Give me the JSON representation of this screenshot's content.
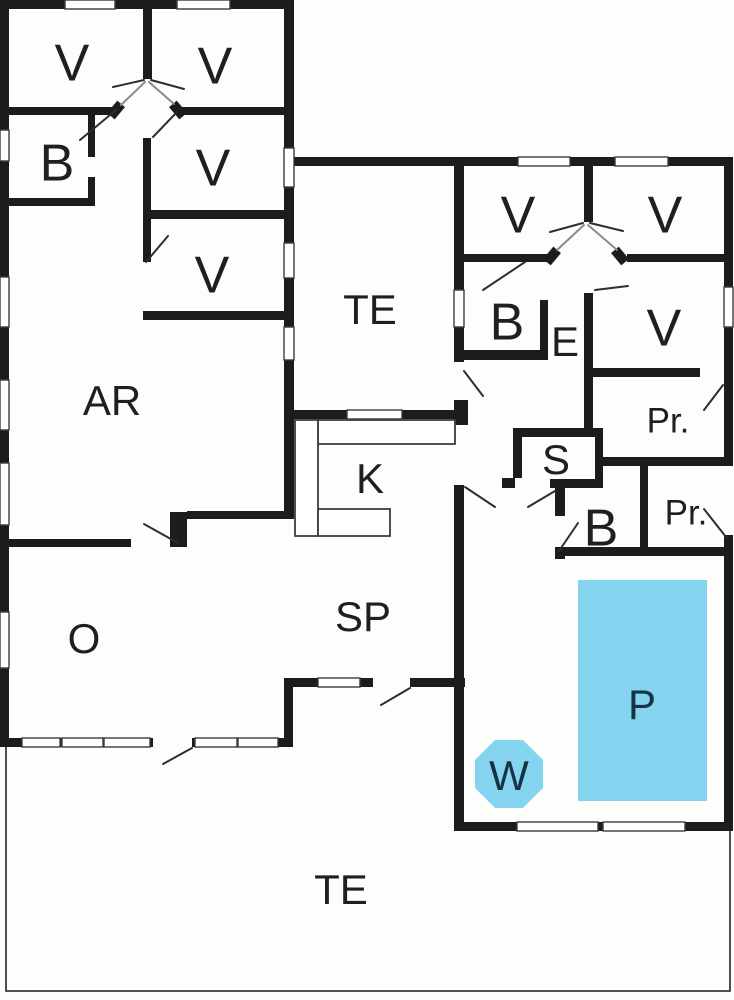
{
  "plan": {
    "type": "floor-plan",
    "colors": {
      "wall": "#1c1c1c",
      "window_line": "#3c3c3c",
      "door_line": "#2e2e2e",
      "slab_line": "#8a8a8a",
      "thin_line": "#3c3c3c",
      "pool_water": "#84d3ef",
      "floor": "#fdfdfb",
      "label": "#1f1f1f",
      "water_label": "#163345"
    }
  },
  "rooms": {
    "v1": {
      "label": "V"
    },
    "v2": {
      "label": "V"
    },
    "b1": {
      "label": "B"
    },
    "v3": {
      "label": "V"
    },
    "v4": {
      "label": "V"
    },
    "ar": {
      "label": "AR"
    },
    "te_atrium": {
      "label": "TE"
    },
    "k": {
      "label": "K"
    },
    "o": {
      "label": "O"
    },
    "sp": {
      "label": "SP"
    },
    "te_garden": {
      "label": "TE"
    },
    "v5": {
      "label": "V"
    },
    "v6": {
      "label": "V"
    },
    "b2": {
      "label": "B"
    },
    "e": {
      "label": "E"
    },
    "v7": {
      "label": "V"
    },
    "pr1": {
      "label": "Pr."
    },
    "s": {
      "label": "S"
    },
    "b3": {
      "label": "B"
    },
    "pr2": {
      "label": "Pr."
    },
    "p": {
      "label": "P"
    },
    "w": {
      "label": "W"
    }
  }
}
